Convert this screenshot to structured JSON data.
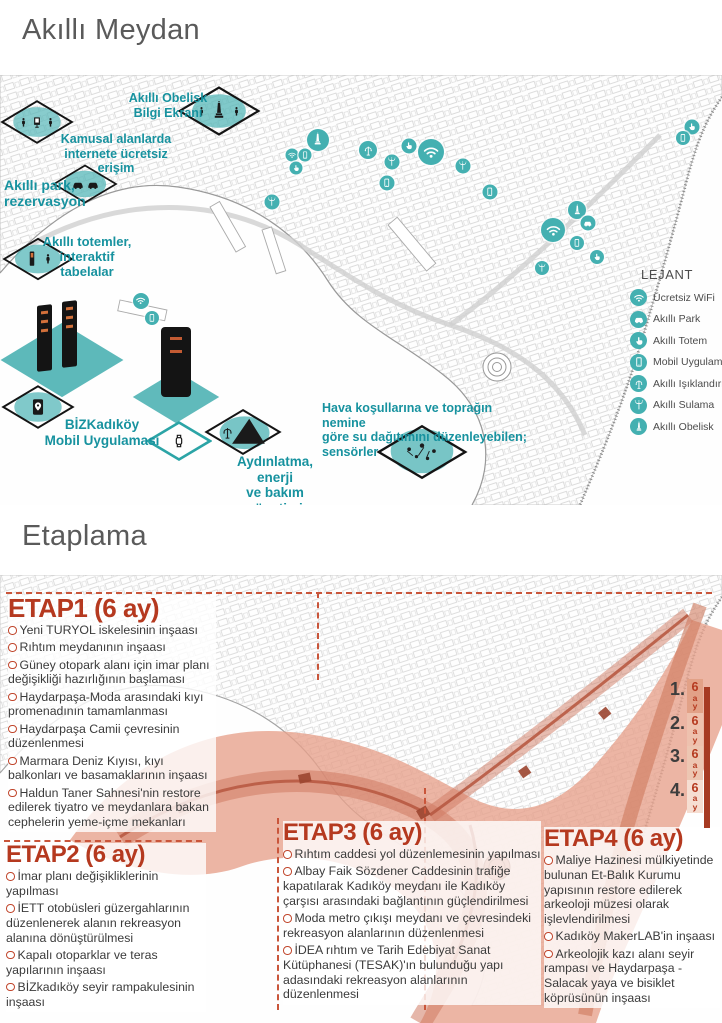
{
  "page": {
    "section1_title": "Akıllı Meydan",
    "section2_title": "Etaplama"
  },
  "akilli_meydan": {
    "callouts": {
      "obelisk": {
        "lines": [
          "Akıllı Obelisk",
          "Bilgi Ekranı"
        ]
      },
      "internet": {
        "lines": [
          "Kamusal alanlarda",
          "internete ücretsiz erişim"
        ]
      },
      "park": {
        "lines": [
          "Akıllı park,",
          "rezervasyon"
        ]
      },
      "totem": {
        "lines": [
          "Akıllı totemler,",
          "interaktif",
          "tabelalar"
        ]
      },
      "mobil": {
        "lines": [
          "BİZKadıköy",
          "Mobil Uygulaması"
        ]
      },
      "aydinlatma": {
        "lines": [
          "Aydınlatma, enerji",
          "ve bakım yönetimi"
        ]
      },
      "sensor": {
        "lines": [
          "Hava koşullarına ve toprağın nemine",
          "göre su dağıtımını düzenleyebilen;",
          "sensörler"
        ]
      }
    },
    "legend": {
      "title": "LEJANT",
      "items": [
        {
          "icon": "wifi-icon",
          "label": "Ücretsiz WiFi"
        },
        {
          "icon": "smart-park-icon",
          "label": "Akıllı Park"
        },
        {
          "icon": "smart-totem-icon",
          "label": "Akıllı Totem"
        },
        {
          "icon": "mobile-app-icon",
          "label": "Mobil Uygulama"
        },
        {
          "icon": "smart-lighting-icon",
          "label": "Akıllı Işıklandırma"
        },
        {
          "icon": "smart-irrigation-icon",
          "label": "Akıllı Sulama"
        },
        {
          "icon": "smart-obelisk-icon",
          "label": "Akıllı Obelisk"
        }
      ]
    }
  },
  "etaplama": {
    "etaplar": [
      {
        "heading": "ETAP1 (6 ay)",
        "items": [
          "Yeni TURYOL iskelesinin inşaası",
          "Rıhtım meydanının inşaası",
          "Güney otopark alanı için imar planı değişikliği hazırlığının başlaması",
          "Haydarpaşa-Moda arasındaki kıyı promenadının tamamlanması",
          "Haydarpaşa Camii çevresinin düzenlenmesi",
          "Marmara Deniz Kıyısı, kıyı balkonları ve basamaklarının inşaası",
          "Haldun Taner Sahnesi'nin restore edilerek tiyatro ve meydanlara bakan cephelerin yeme-içme mekanları"
        ]
      },
      {
        "heading": "ETAP2 (6 ay)",
        "items": [
          "İmar planı değişikliklerinin yapılması",
          "İETT otobüsleri güzergahlarının düzenlenerek alanın rekreasyon alanına dönüştürülmesi",
          "Kapalı otoparklar ve teras yapılarının inşaası",
          "BİZkadıköy seyir rampakulesinin inşaası"
        ]
      },
      {
        "heading": "ETAP3 (6 ay)",
        "items": [
          "Rıhtım caddesi yol düzenlemesinin yapılması",
          "Albay Faik Sözdener Caddesinin trafiğe kapatılarak Kadıköy meydanı ile Kadıköy çarşısı arasındaki bağlantının güçlendirilmesi",
          "Moda metro çıkışı meydanı ve çevresindeki rekreasyon alanlarının düzenlenmesi",
          "İDEA rıhtım ve Tarih Edebiyat Sanat Kütüphanesi (TESAK)'ın bulunduğu yapı adasındaki rekreasyon alanlarının düzenlenmesi"
        ]
      },
      {
        "heading": "ETAP4 (6 ay)",
        "items": [
          "Maliye Hazinesi mülkiyetinde bulunan Et-Balık Kurumu yapısının restore edilerek arkeoloji müzesi olarak işlevlendirilmesi",
          "Kadıköy MakerLAB'in inşaası",
          "Arkeolojik kazı alanı seyir rampası ve Haydarpaşa -Salacak yaya ve bisiklet köprüsünün inşaası"
        ]
      }
    ],
    "timeline": [
      {
        "number": "1.",
        "chars": [
          "6",
          "a",
          "y"
        ]
      },
      {
        "number": "2.",
        "chars": [
          "6",
          "a",
          "y"
        ]
      },
      {
        "number": "3.",
        "chars": [
          "6",
          "a",
          "y"
        ]
      },
      {
        "number": "4.",
        "chars": [
          "6",
          "a",
          "y"
        ]
      }
    ]
  },
  "colors": {
    "teal": "#44b0b1",
    "teal_text": "#17929f",
    "etap_red": "#b5391f",
    "salmon_overlay": "#e7a08b",
    "timeline_bar": "#a63a22",
    "title_gray": "#5a5a5a"
  }
}
